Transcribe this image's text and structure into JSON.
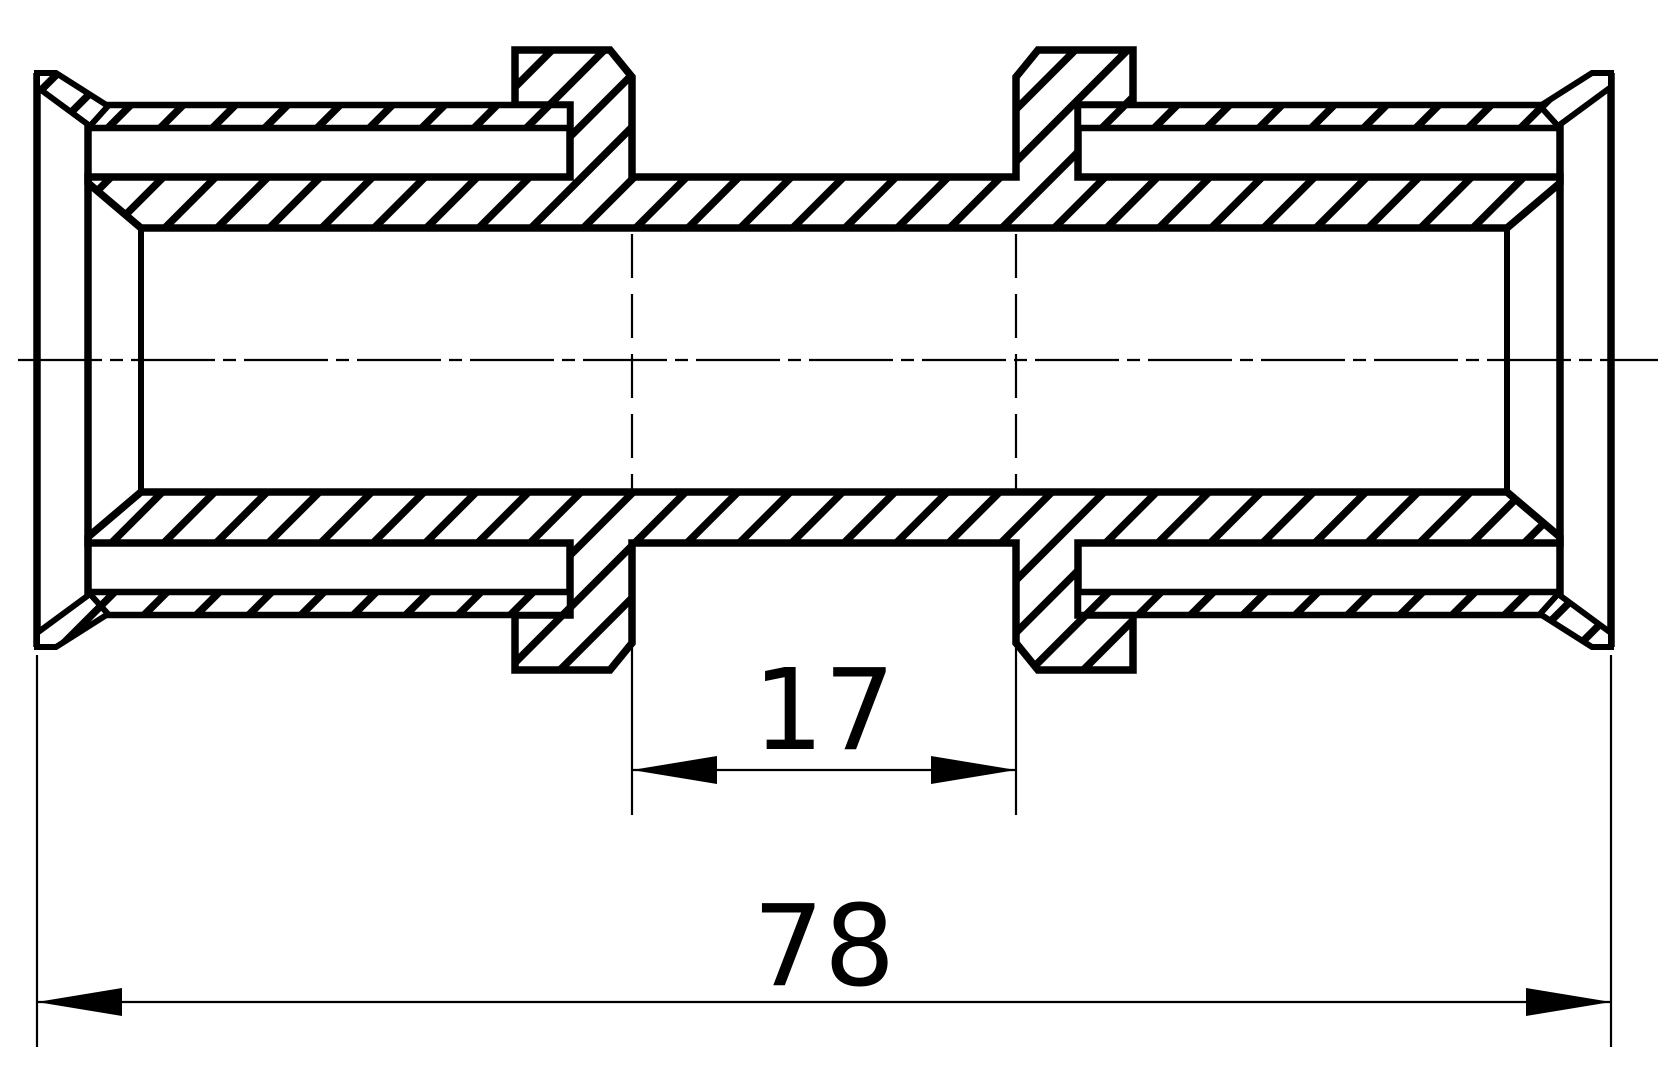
{
  "drawing": {
    "background_color": "#ffffff",
    "line_color": "#000000",
    "type": "cross-section of a sliding-sleeve pipe coupling fitting",
    "dimensions": {
      "center_section": {
        "label": "17"
      },
      "overall_length": {
        "label": "78"
      }
    }
  }
}
